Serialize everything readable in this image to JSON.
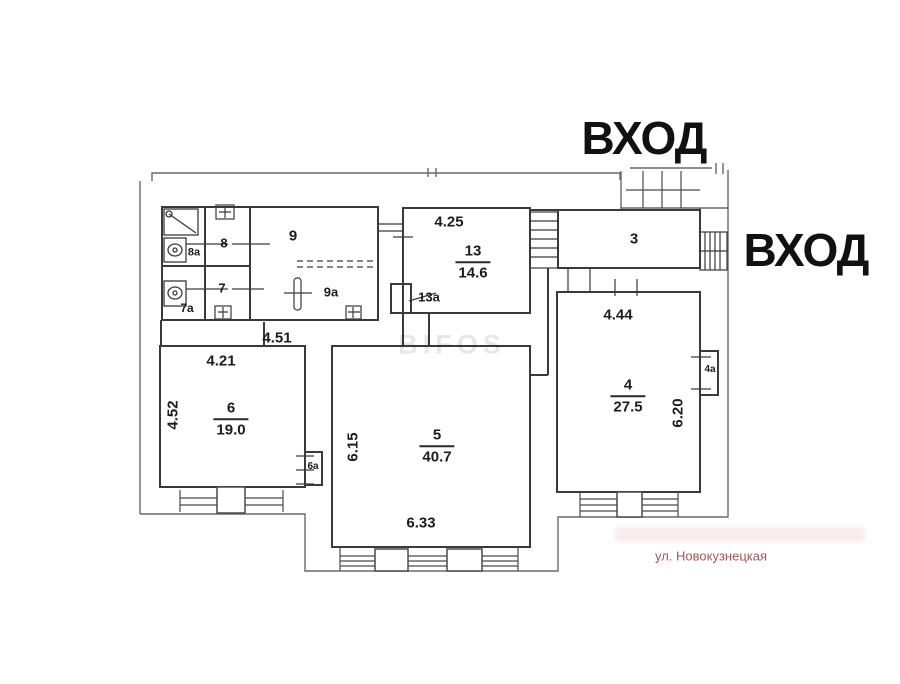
{
  "labels": {
    "entrance_top": "ВХОД",
    "entrance_right": "ВХОД",
    "street": "ул. Новокузнецкая",
    "watermark": "BIFOS"
  },
  "rooms": {
    "r3": {
      "number": "3"
    },
    "r4": {
      "number": "4",
      "area": "27.5"
    },
    "r4a": {
      "number": "4a"
    },
    "r5": {
      "number": "5",
      "area": "40.7"
    },
    "r6": {
      "number": "6",
      "area": "19.0"
    },
    "r6a": {
      "number": "6a"
    },
    "r7": {
      "number": "7"
    },
    "r7a": {
      "number": "7a"
    },
    "r8": {
      "number": "8"
    },
    "r8a": {
      "number": "8a"
    },
    "r9": {
      "number": "9"
    },
    "r9a": {
      "number": "9a"
    },
    "r13": {
      "number": "13",
      "area": "14.6"
    },
    "r13a": {
      "number": "13a"
    }
  },
  "dimensions": {
    "top_room13": "4.25",
    "top_room4": "4.44",
    "top_room6": "4.21",
    "hallway": "4.51",
    "left_room6": "4.52",
    "left_room5": "6.15",
    "bottom_room5": "6.33",
    "right_room4": "6.20"
  },
  "colors": {
    "wall_line": "#3a3a3a",
    "site_line": "#6a6a6a",
    "street_text": "#a3565a",
    "watermark_text": "#d9d9d9"
  }
}
